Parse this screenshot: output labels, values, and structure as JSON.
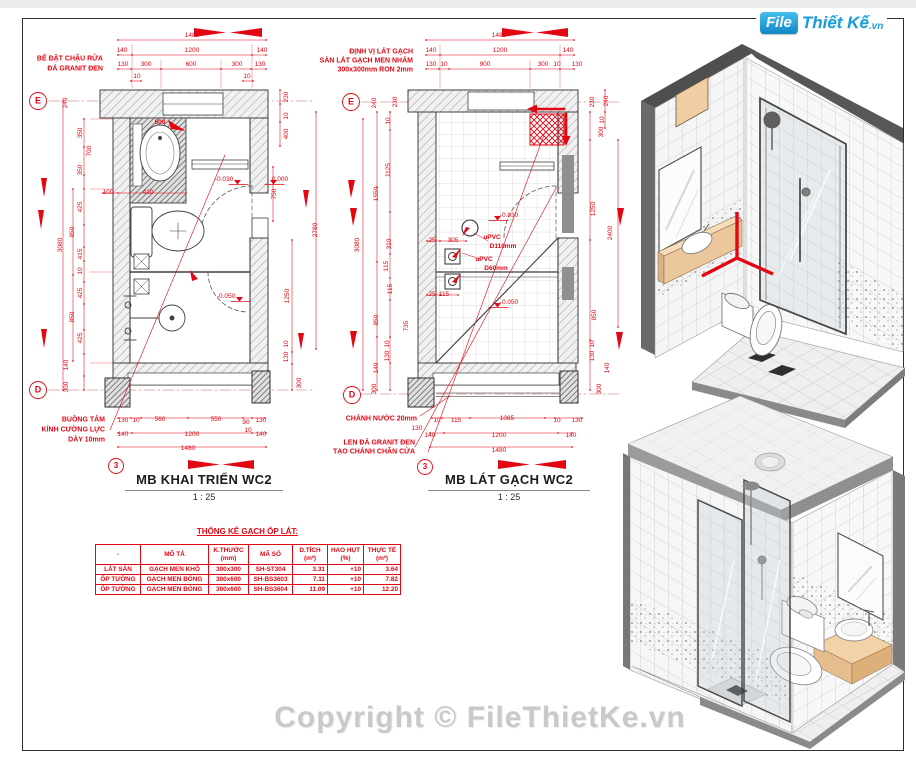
{
  "colors": {
    "annotation_red": "#e30613",
    "plan_line": "#3f3f3f",
    "logo_blue": "#1b9dd9",
    "copyright_gray": "#c9c9c9",
    "wood_tan": "#ecc79b"
  },
  "logo": {
    "box": "File",
    "name": "Thiết Kế",
    "tld": ".vn"
  },
  "copyright": "Copyright © FileThietKe.vn",
  "plan_left": {
    "title": "MB KHAI TRIỂN WC2",
    "scale": "1 : 25",
    "labels": [
      {
        "t": "1480",
        "x": 192,
        "y": 36
      },
      {
        "t": "140",
        "x": 122,
        "y": 51
      },
      {
        "t": "1200",
        "x": 192,
        "y": 51
      },
      {
        "t": "140",
        "x": 262,
        "y": 51
      },
      {
        "t": "130",
        "x": 123,
        "y": 65
      },
      {
        "t": "300",
        "x": 146,
        "y": 65
      },
      {
        "t": "600",
        "x": 191,
        "y": 65
      },
      {
        "t": "300",
        "x": 237,
        "y": 65
      },
      {
        "t": "130",
        "x": 260,
        "y": 65
      },
      {
        "t": "10",
        "x": 137,
        "y": 77
      },
      {
        "t": "10",
        "x": 247,
        "y": 77
      },
      {
        "t": "BỂ ĐẶT CHẬU RỬA",
        "x": 103,
        "y": 59,
        "a": "r",
        "b": 1,
        "s": 7
      },
      {
        "t": "ĐÁ GRANIT ĐEN",
        "x": 103,
        "y": 69,
        "a": "r",
        "b": 1,
        "s": 7
      },
      {
        "t": "E",
        "x": 38,
        "y": 101,
        "s": 9,
        "b": 1
      },
      {
        "t": "240",
        "x": 66,
        "y": 103,
        "r": 1
      },
      {
        "t": "350",
        "x": 81,
        "y": 133,
        "r": 1
      },
      {
        "t": "700",
        "x": 90,
        "y": 151,
        "r": 1
      },
      {
        "t": "350",
        "x": 81,
        "y": 170,
        "r": 1
      },
      {
        "t": "3080",
        "x": 61,
        "y": 245,
        "r": 1
      },
      {
        "t": "425",
        "x": 81,
        "y": 207,
        "r": 1
      },
      {
        "t": "850",
        "x": 73,
        "y": 232,
        "r": 1
      },
      {
        "t": "415",
        "x": 81,
        "y": 254,
        "r": 1
      },
      {
        "t": "10",
        "x": 81,
        "y": 271,
        "r": 1
      },
      {
        "t": "425",
        "x": 81,
        "y": 293,
        "r": 1
      },
      {
        "t": "850",
        "x": 73,
        "y": 317,
        "r": 1
      },
      {
        "t": "425",
        "x": 81,
        "y": 338,
        "r": 1
      },
      {
        "t": "140",
        "x": 67,
        "y": 365,
        "r": 1
      },
      {
        "t": "300",
        "x": 67,
        "y": 387,
        "r": 1
      },
      {
        "t": "D",
        "x": 38,
        "y": 390,
        "s": 9,
        "b": 1
      },
      {
        "t": "500",
        "x": 160,
        "y": 123,
        "b": 1
      },
      {
        "t": "100",
        "x": 108,
        "y": 193
      },
      {
        "t": "430",
        "x": 148,
        "y": 193
      },
      {
        "t": "-0.030",
        "x": 224,
        "y": 180
      },
      {
        "t": "0.000",
        "x": 280,
        "y": 180
      },
      {
        "t": "-0.050",
        "x": 226,
        "y": 297
      },
      {
        "t": "230",
        "x": 287,
        "y": 97,
        "r": 1
      },
      {
        "t": "10",
        "x": 287,
        "y": 116,
        "r": 1
      },
      {
        "t": "400",
        "x": 287,
        "y": 134,
        "r": 1
      },
      {
        "t": "750",
        "x": 275,
        "y": 194,
        "r": 1
      },
      {
        "t": "2780",
        "x": 316,
        "y": 230,
        "r": 1
      },
      {
        "t": "1250",
        "x": 288,
        "y": 296,
        "r": 1
      },
      {
        "t": "10",
        "x": 287,
        "y": 344,
        "r": 1
      },
      {
        "t": "130",
        "x": 287,
        "y": 357,
        "r": 1
      },
      {
        "t": "300",
        "x": 300,
        "y": 383,
        "r": 1
      },
      {
        "t": "BUỒNG TẮM",
        "x": 105,
        "y": 420,
        "a": "r",
        "b": 1,
        "s": 7
      },
      {
        "t": "KÍNH CƯỜNG LỰC",
        "x": 105,
        "y": 430,
        "a": "r",
        "b": 1,
        "s": 7
      },
      {
        "t": "DÀY 10mm",
        "x": 105,
        "y": 440,
        "a": "r",
        "b": 1,
        "s": 7
      },
      {
        "t": "130",
        "x": 123,
        "y": 421
      },
      {
        "t": "10",
        "x": 136,
        "y": 421
      },
      {
        "t": "560",
        "x": 160,
        "y": 420
      },
      {
        "t": "550",
        "x": 216,
        "y": 420
      },
      {
        "t": "90",
        "x": 246,
        "y": 423
      },
      {
        "t": "130",
        "x": 261,
        "y": 421
      },
      {
        "t": "10",
        "x": 248,
        "y": 431
      },
      {
        "t": "140",
        "x": 123,
        "y": 435
      },
      {
        "t": "1200",
        "x": 192,
        "y": 435
      },
      {
        "t": "140",
        "x": 261,
        "y": 435
      },
      {
        "t": "1480",
        "x": 188,
        "y": 449
      },
      {
        "t": "3",
        "x": 116,
        "y": 466,
        "s": 8,
        "b": 1
      }
    ]
  },
  "plan_right": {
    "title": "MB LÁT GẠCH WC2",
    "scale": "1 : 25",
    "labels": [
      {
        "t": "ĐỊNH VỊ LÁT GẠCH",
        "x": 413,
        "y": 52,
        "a": "r",
        "b": 1,
        "s": 7
      },
      {
        "t": "SÀN LÁT GẠCH MEN NHÁM",
        "x": 413,
        "y": 61,
        "a": "r",
        "b": 1,
        "s": 7
      },
      {
        "t": "300x300mm RON 2mm",
        "x": 413,
        "y": 70,
        "a": "r",
        "b": 1,
        "s": 7
      },
      {
        "t": "1480",
        "x": 499,
        "y": 36
      },
      {
        "t": "140",
        "x": 431,
        "y": 51
      },
      {
        "t": "1200",
        "x": 500,
        "y": 51
      },
      {
        "t": "140",
        "x": 568,
        "y": 51
      },
      {
        "t": "130",
        "x": 431,
        "y": 65
      },
      {
        "t": "10",
        "x": 444,
        "y": 65
      },
      {
        "t": "900",
        "x": 485,
        "y": 65
      },
      {
        "t": "300",
        "x": 543,
        "y": 65
      },
      {
        "t": "10",
        "x": 557,
        "y": 65
      },
      {
        "t": "130",
        "x": 577,
        "y": 65
      },
      {
        "t": "E",
        "x": 351,
        "y": 102,
        "s": 9,
        "b": 1
      },
      {
        "t": "240",
        "x": 375,
        "y": 103,
        "r": 1
      },
      {
        "t": "230",
        "x": 396,
        "y": 102,
        "r": 1
      },
      {
        "t": "10",
        "x": 389,
        "y": 121,
        "r": 1
      },
      {
        "t": "1125",
        "x": 389,
        "y": 170,
        "r": 1
      },
      {
        "t": "1550",
        "x": 377,
        "y": 194,
        "r": 1
      },
      {
        "t": "3080",
        "x": 358,
        "y": 245,
        "r": 1
      },
      {
        "t": "310",
        "x": 390,
        "y": 244,
        "r": 1
      },
      {
        "t": "115",
        "x": 387,
        "y": 266,
        "r": 1
      },
      {
        "t": "115",
        "x": 391,
        "y": 289,
        "r": 1
      },
      {
        "t": "850",
        "x": 377,
        "y": 320,
        "r": 1
      },
      {
        "t": "735",
        "x": 407,
        "y": 326,
        "r": 1
      },
      {
        "t": "10",
        "x": 388,
        "y": 344,
        "r": 1
      },
      {
        "t": "130",
        "x": 388,
        "y": 356,
        "r": 1
      },
      {
        "t": "140",
        "x": 377,
        "y": 368,
        "r": 1
      },
      {
        "t": "300",
        "x": 375,
        "y": 389,
        "r": 1
      },
      {
        "t": "D",
        "x": 352,
        "y": 395,
        "s": 9,
        "b": 1
      },
      {
        "t": "230",
        "x": 593,
        "y": 102,
        "r": 1
      },
      {
        "t": "240",
        "x": 607,
        "y": 101,
        "r": 1
      },
      {
        "t": "10",
        "x": 603,
        "y": 120,
        "r": 1
      },
      {
        "t": "300",
        "x": 602,
        "y": 132,
        "r": 1
      },
      {
        "t": "1250",
        "x": 594,
        "y": 209,
        "r": 1
      },
      {
        "t": "2400",
        "x": 611,
        "y": 233,
        "r": 1
      },
      {
        "t": "850",
        "x": 595,
        "y": 315,
        "r": 1
      },
      {
        "t": "10",
        "x": 593,
        "y": 344,
        "r": 1
      },
      {
        "t": "130",
        "x": 593,
        "y": 356,
        "r": 1
      },
      {
        "t": "140",
        "x": 608,
        "y": 368,
        "r": 1
      },
      {
        "t": "300",
        "x": 600,
        "y": 389,
        "r": 1
      },
      {
        "t": "-0.030",
        "x": 509,
        "y": 216
      },
      {
        "t": "25",
        "x": 432,
        "y": 241
      },
      {
        "t": "305",
        "x": 453,
        "y": 241
      },
      {
        "t": "uPVC",
        "x": 492,
        "y": 238,
        "b": 1
      },
      {
        "t": "D110mm",
        "x": 503,
        "y": 247,
        "b": 1
      },
      {
        "t": "uPVC",
        "x": 484,
        "y": 260,
        "b": 1
      },
      {
        "t": "D60mm",
        "x": 496,
        "y": 269,
        "b": 1
      },
      {
        "t": "25",
        "x": 432,
        "y": 295
      },
      {
        "t": "115",
        "x": 444,
        "y": 295
      },
      {
        "t": "-0.050",
        "x": 509,
        "y": 303
      },
      {
        "t": "CHÁNH NƯỚC  20mm",
        "x": 417,
        "y": 419,
        "a": "r",
        "b": 1,
        "s": 7
      },
      {
        "t": "10",
        "x": 437,
        "y": 421
      },
      {
        "t": "115",
        "x": 456,
        "y": 421
      },
      {
        "t": "1085",
        "x": 507,
        "y": 419
      },
      {
        "t": "10",
        "x": 557,
        "y": 421
      },
      {
        "t": "130",
        "x": 577,
        "y": 421
      },
      {
        "t": "130",
        "x": 417,
        "y": 429
      },
      {
        "t": "140",
        "x": 430,
        "y": 436
      },
      {
        "t": "1200",
        "x": 499,
        "y": 436
      },
      {
        "t": "140",
        "x": 571,
        "y": 436
      },
      {
        "t": "1480",
        "x": 499,
        "y": 451
      },
      {
        "t": "LEN ĐÁ GRANIT ĐEN",
        "x": 415,
        "y": 443,
        "a": "r",
        "b": 1,
        "s": 7
      },
      {
        "t": "TẠO CHÁNH CHÂN CỬA",
        "x": 415,
        "y": 452,
        "a": "r",
        "b": 1,
        "s": 7
      },
      {
        "t": "3",
        "x": 425,
        "y": 467,
        "s": 8,
        "b": 1
      }
    ]
  },
  "table": {
    "heading": "THỐNG KÊ GẠCH ỐP LÁT:",
    "headers": [
      {
        "l1": "-",
        "l2": ""
      },
      {
        "l1": "MÔ TẢ",
        "l2": ""
      },
      {
        "l1": "K.THƯỚC",
        "l2": "(mm)"
      },
      {
        "l1": "MÃ SỐ",
        "l2": ""
      },
      {
        "l1": "D.TÍCH",
        "l2": "(m²)"
      },
      {
        "l1": "HAO HỤT",
        "l2": "(%)"
      },
      {
        "l1": "THỰC TẾ",
        "l2": "(m²)"
      }
    ],
    "rows": [
      [
        "LÁT SÀN",
        "GẠCH MEN KHÔ",
        "300x300",
        "SH-ST304",
        "3.31",
        "+10",
        "3.64"
      ],
      [
        "ỐP TƯỜNG",
        "GẠCH MEN BÓNG",
        "300x600",
        "SH-BS3603",
        "7.11",
        "+10",
        "7.82"
      ],
      [
        "ỐP TƯỜNG",
        "GẠCH MEN BÓNG",
        "300x600",
        "SH-BS3604",
        "11.09",
        "+10",
        "12.20"
      ]
    ]
  }
}
